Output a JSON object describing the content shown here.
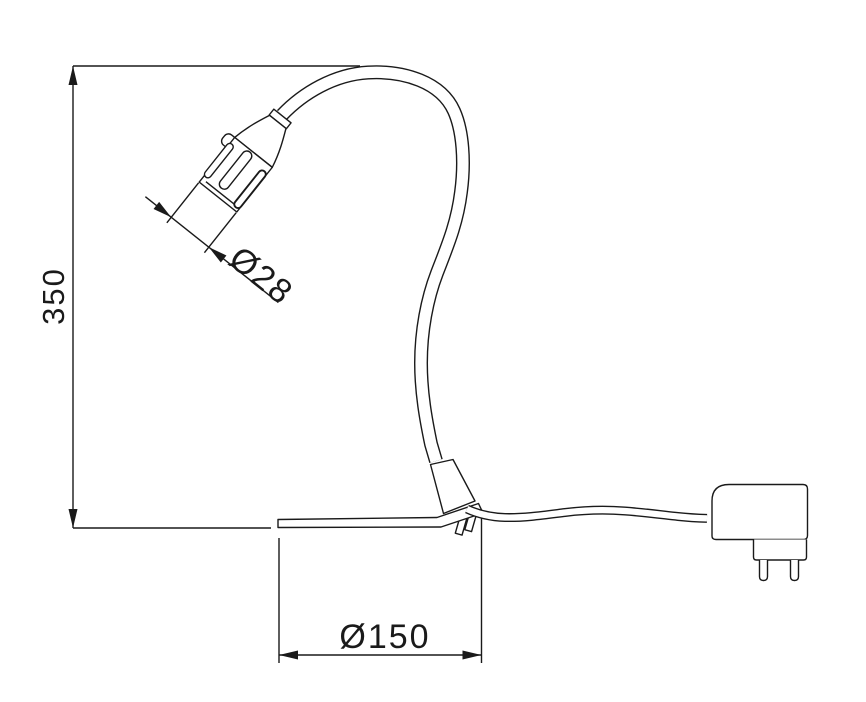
{
  "diagram": {
    "title": "gooseneck-lamp-dimension-drawing",
    "dimensions": {
      "height": {
        "label": "350"
      },
      "head_diameter": {
        "label": "Ø28"
      },
      "base_diameter": {
        "label": "Ø150"
      }
    },
    "colors": {
      "line": "#1a1a1a",
      "background": "#ffffff"
    }
  }
}
